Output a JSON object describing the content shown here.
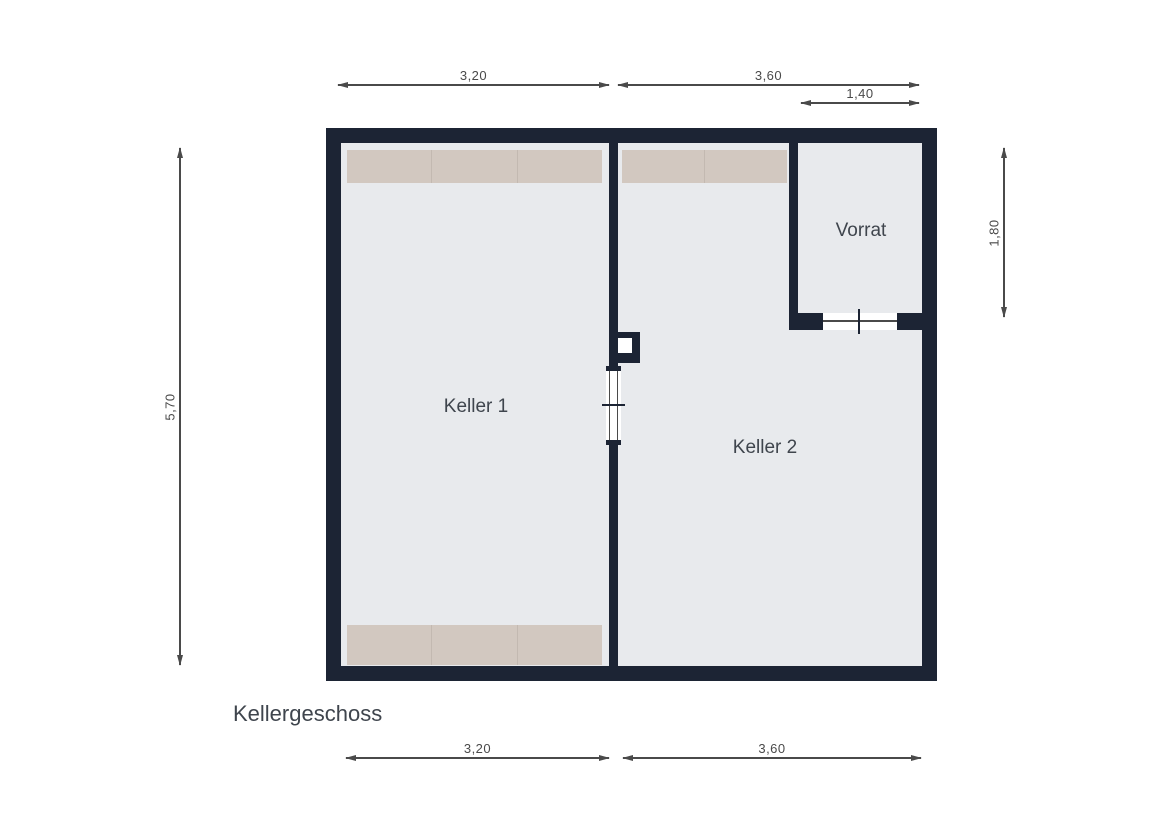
{
  "floor_label": "Kellergeschoss",
  "rooms": {
    "keller1": {
      "label": "Keller 1"
    },
    "keller2": {
      "label": "Keller 2"
    },
    "vorrat": {
      "label": "Vorrat"
    }
  },
  "dimensions": {
    "top_keller1_width": "3,20",
    "top_keller2_width": "3,60",
    "vorrat_width": "1,40",
    "building_height": "5,70",
    "vorrat_height": "1,80",
    "bottom_keller1_width": "3,20",
    "bottom_keller2_width": "3,60"
  },
  "colors": {
    "wall": "#1c2434",
    "floor": "#e8eaed",
    "shelving": "#d2c8c0",
    "shelving_divider": "#c3b9b1",
    "door_opening": "#ffffff",
    "dimension": "#4a4a4a",
    "room_label": "#3f454d",
    "background": "#ffffff"
  }
}
